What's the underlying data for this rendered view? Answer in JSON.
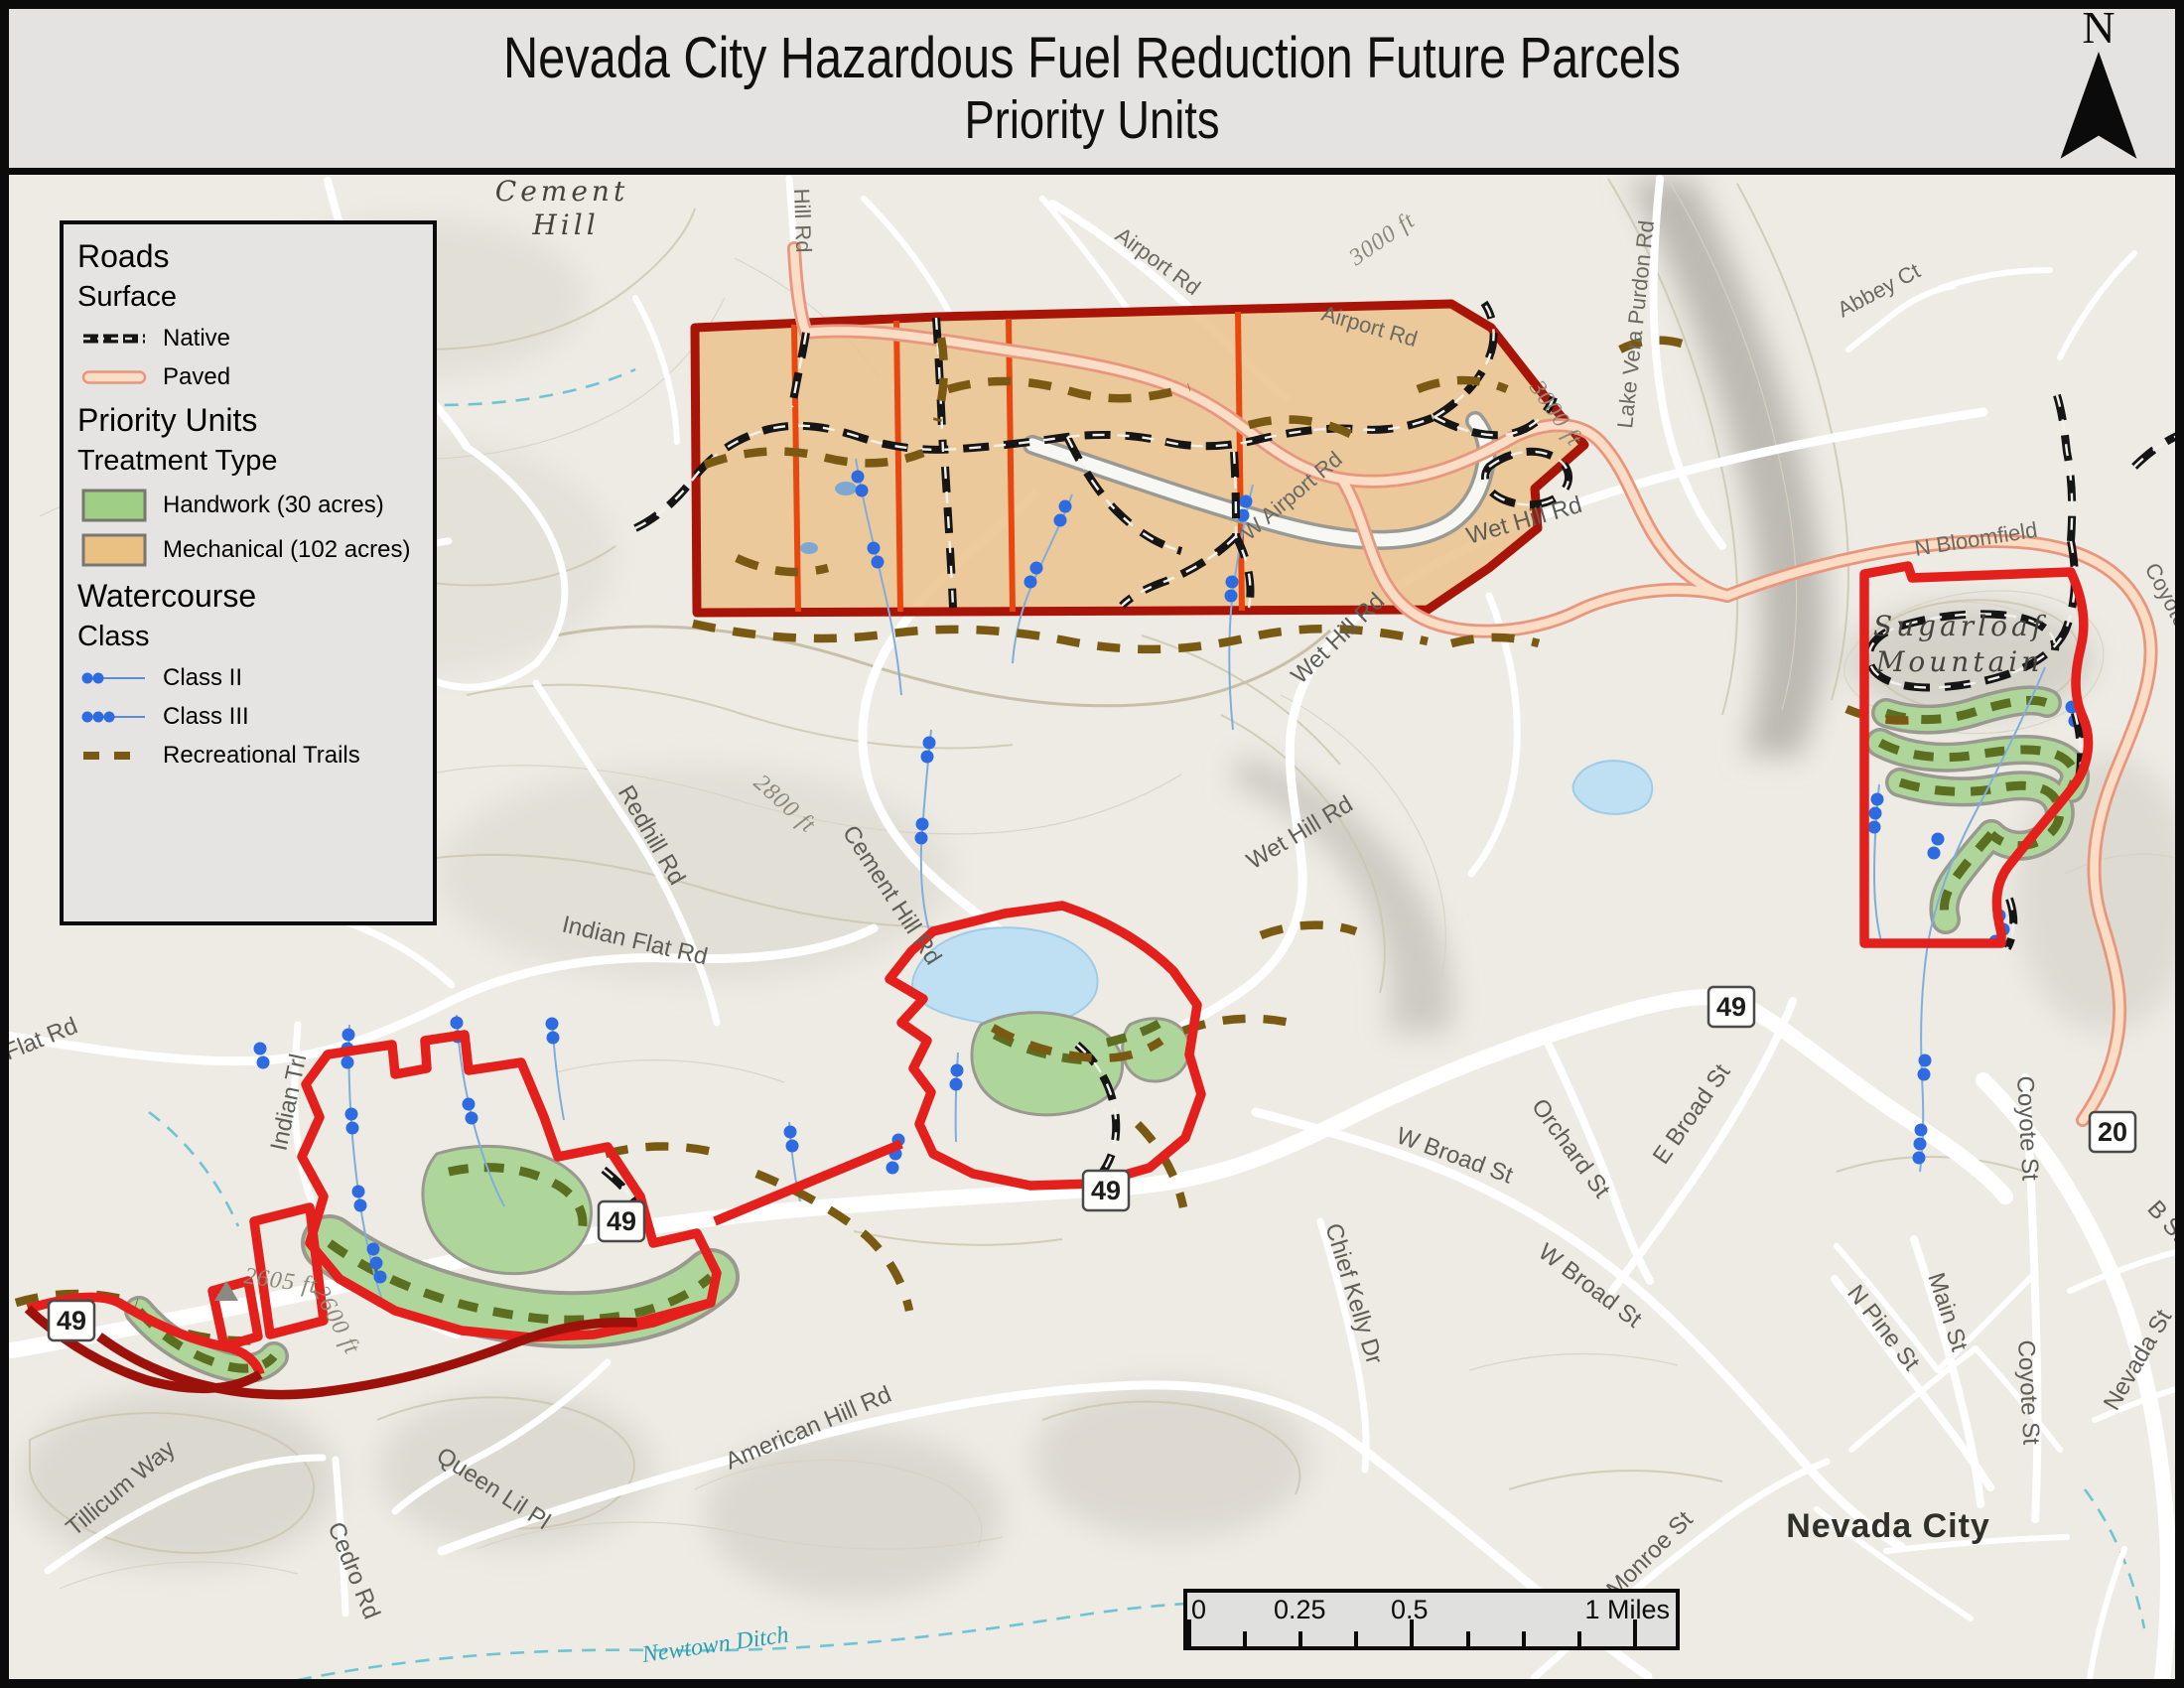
{
  "title": {
    "line1": "Nevada City Hazardous Fuel Reduction Future Parcels",
    "line2": "Priority Units"
  },
  "north_arrow": {
    "label": "N"
  },
  "legend": {
    "sections": [
      {
        "heading": "Roads",
        "subheading": "Surface",
        "items": [
          {
            "icon": "native-road-symbol",
            "label": "Native"
          },
          {
            "icon": "paved-road-symbol",
            "label": "Paved"
          }
        ]
      },
      {
        "heading": "Priority Units",
        "subheading": "Treatment Type",
        "items": [
          {
            "icon": "handwork-swatch",
            "label": "Handwork (30 acres)"
          },
          {
            "icon": "mechanical-swatch",
            "label": "Mechanical (102 acres)"
          }
        ]
      },
      {
        "heading": "Watercourse",
        "subheading": "Class",
        "items": [
          {
            "icon": "class-ii-symbol",
            "label": "Class II"
          },
          {
            "icon": "class-iii-symbol",
            "label": "Class III"
          },
          {
            "icon": "recreational-trails-symbol",
            "label": "Recreational Trails"
          }
        ]
      }
    ]
  },
  "map": {
    "labels": {
      "cement_hill_1": "Cement",
      "cement_hill_2": "Hill",
      "hill_rd": "Hill Rd",
      "airport_rd": "Airport Rd",
      "w_airport_rd": "W Airport Rd",
      "ft_3000": "3000 ft",
      "lake_vera": "Lake Vera Purdon Rd",
      "abbey_ct": "Abbey Ct",
      "n_bloomfield": "N Bloomfield",
      "coyote_st": "Coyote St",
      "sugarloaf_1": "Sugarloaf",
      "sugarloaf_2": "Mountain",
      "wet_hill_rd": "Wet Hill Rd",
      "cement_hill_rd": "Cement Hill Rd",
      "ft_2800": "2800 ft",
      "redhill_rd": "Redhill Rd",
      "indian_flat_rd": "Indian Flat Rd",
      "flat_rd": "Flat Rd",
      "indian_trl": "Indian Trl",
      "ft_2605": "2605 ft",
      "ft_2600": "2600 ft",
      "w_broad_st": "W Broad St",
      "orchard_st": "Orchard St",
      "e_broad_st": "E Broad St",
      "chief_kelly_dr": "Chief Kelly Dr",
      "n_pine_st": "N Pine St",
      "main_st": "Main St",
      "b_st": "B St",
      "nevada_st": "Nevada St",
      "nevada_city": "Nevada City",
      "monroe_st": "Monroe St",
      "american_hill_rd": "American Hill Rd",
      "queen_lil_pl": "Queen Lil Pl",
      "tillicum_way": "Tillicum Way",
      "cedro_rd": "Cedro Rd",
      "newtown_ditch": "Newtown Ditch"
    },
    "shields": {
      "route49": "49",
      "route20": "20"
    },
    "colors": {
      "priority_unit_outline": "#e3201b",
      "mechanical_outline": "#9c120b",
      "mechanical_fill": "#ebc48f",
      "handwork_fill": "#afd69a",
      "paved_fill": "#fbdcc4",
      "paved_casing": "#e8967d",
      "native_road": "#151515",
      "recreational_trail": "#7a5a12",
      "watercourse_dot": "#2e6be0",
      "map_background": "#edebe4"
    }
  },
  "scale_bar": {
    "tick0": "0",
    "tick1": "0.25",
    "tick2": "0.5",
    "end": "1 Miles"
  }
}
